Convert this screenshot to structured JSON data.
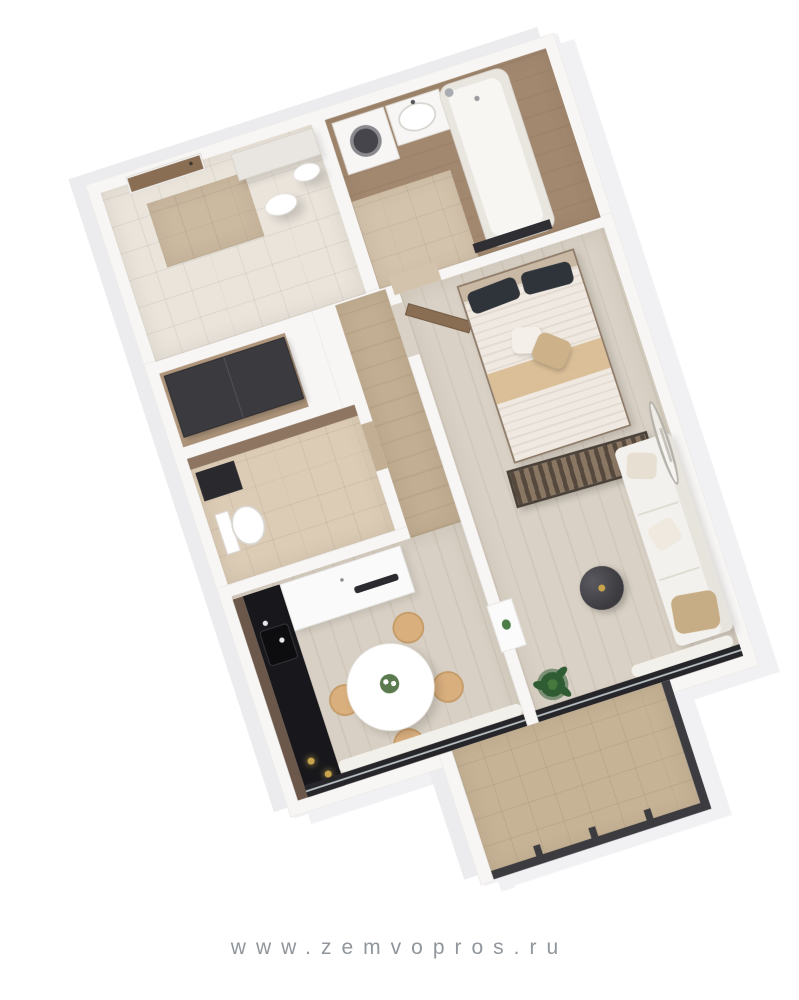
{
  "watermark": {
    "text": "www.zemvopros.ru"
  },
  "colors": {
    "page_bg": "#ffffff",
    "shadow_a": "#ececef",
    "shadow_b": "#f1f1f4",
    "wall": "#f7f6f5",
    "wall_edge": "#ecebe9",
    "floor_hall": "#eae4db",
    "floor_bath": "#a2886f",
    "tile_beige": "#d4c3ac",
    "floor_niche": "#b79d82",
    "floor_wc": "#dcccb6",
    "floor_corridor": "#c2ae92",
    "floor_kitchen": "#d8d0c4",
    "floor_bedroom": "#d9d1c5",
    "floor_balcony": "#c6b295",
    "wardrobe": "#3a3a3f",
    "counter_dark": "#18181c",
    "counter_wood": "#6b584a",
    "cabinet_white": "#fafafa",
    "door_brown": "#8a6e54",
    "bed_stripe_a": "#efe9e1",
    "bed_stripe_b": "#e3dbd1",
    "runner_tan": "#d9bd94",
    "headboard": "#c9b8a4",
    "pillow_dark": "#2f343b",
    "pillow_tan": "#cdb189",
    "sofa": "#f3f1ed",
    "sofa_back": "#e7e3dd",
    "blanket": "#c7ad85",
    "frame_dark": "#26262a",
    "railing": "#3c3c40",
    "chair_wood": "#d9af7e",
    "table_white": "#ffffff",
    "plant_green": "#2f5c33",
    "plant_light": "#47793f",
    "gold": "#c9a44c",
    "fixture_white": "#f7f6f4",
    "watermark": "#90969b"
  },
  "floorplan": {
    "type": "apartment-3d-top-view",
    "rotation_deg": -18,
    "rooms": [
      "hallway",
      "bathroom",
      "wc",
      "wardrobe-niche",
      "corridor",
      "kitchen",
      "bedroom-living",
      "balcony"
    ],
    "furniture": {
      "hallway": [
        "entrance-door",
        "door-mat",
        "bench",
        "ceiling-lamps"
      ],
      "bathroom": [
        "washing-machine",
        "sink",
        "bathtub",
        "bath-mat"
      ],
      "wc": [
        "toilet",
        "vanity"
      ],
      "kitchen": [
        "dark-counter",
        "kitchen-sink",
        "upper-cabinet",
        "dining-table",
        "dining-chairs",
        "window-curtain"
      ],
      "bedroom_living": [
        "room-door",
        "double-bed",
        "dark-pillows",
        "bed-runner",
        "slat-bench",
        "sofa",
        "throw-pillows",
        "coffee-table",
        "potted-plant",
        "oval-mirror",
        "panorama-window"
      ],
      "balcony": [
        "tiled-floor",
        "railing"
      ]
    }
  }
}
